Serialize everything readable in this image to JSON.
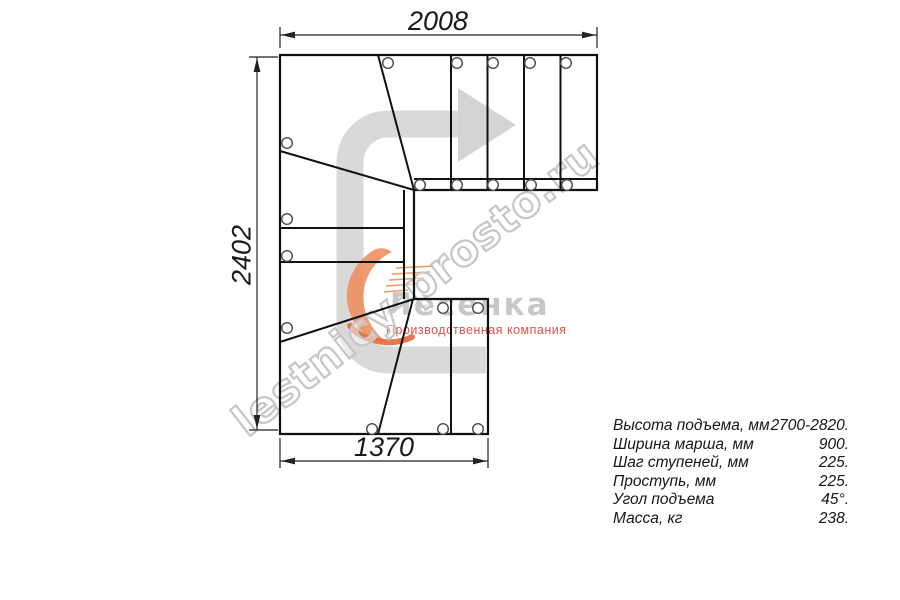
{
  "dimensions": {
    "top": "2008",
    "left": "2402",
    "bottom": "1370"
  },
  "watermark_text": "lestnicy-prosto.ru",
  "logo": {
    "name": "Лесенка",
    "tagline": "Производственная компания"
  },
  "specs": {
    "rows": [
      {
        "label": "Высота подъема, мм",
        "value": "2700-2820."
      },
      {
        "label": "Ширина марша, мм",
        "value": "900."
      },
      {
        "label": "Шаг ступеней, мм",
        "value": "225."
      },
      {
        "label": "Проступь, мм",
        "value": "225."
      },
      {
        "label": "Угол подъема",
        "value": "45°."
      },
      {
        "label": "Масса, кг",
        "value": "238."
      }
    ]
  },
  "icons": {
    "direction_arrow": "direction-of-travel-arrow",
    "logo_swoosh": "orange-staircase-swoosh",
    "fastener_marks": "bolt-hole-circles"
  },
  "colors": {
    "line": "#1a1a1a",
    "arrow_fill": "#d4d4d4",
    "watermark_stroke": "#c6c6c6",
    "logo_text": "#c8c8c8",
    "tagline": "#db5349"
  }
}
